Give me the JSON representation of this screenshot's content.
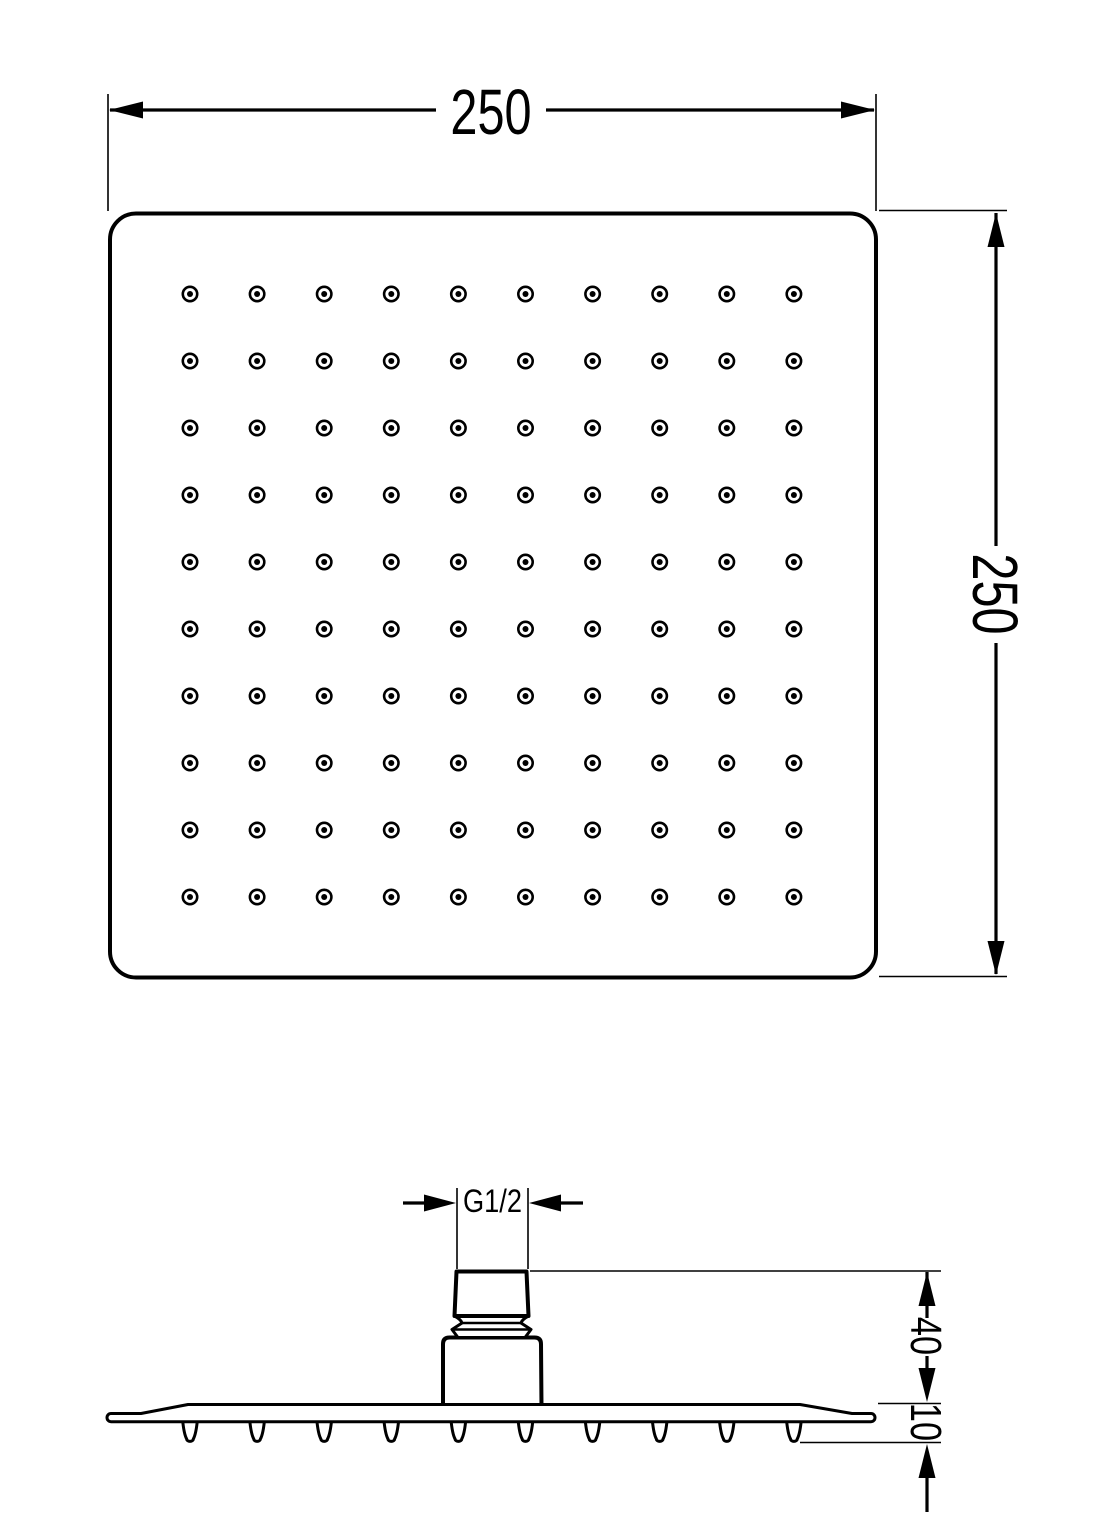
{
  "drawing": {
    "kind": "technical-dimension-drawing",
    "subject": "square rain shower head",
    "background_color": "#ffffff",
    "line_color": "#000000",
    "top_view": {
      "width_label": "250",
      "height_label": "250",
      "nozzle_rows": 10,
      "nozzle_cols": 10,
      "nozzle_count": 100
    },
    "side_view": {
      "thread_label": "G1/2",
      "connector_height_label": "40",
      "plate_thickness_label": "10",
      "nozzle_nub_count": 10
    }
  }
}
